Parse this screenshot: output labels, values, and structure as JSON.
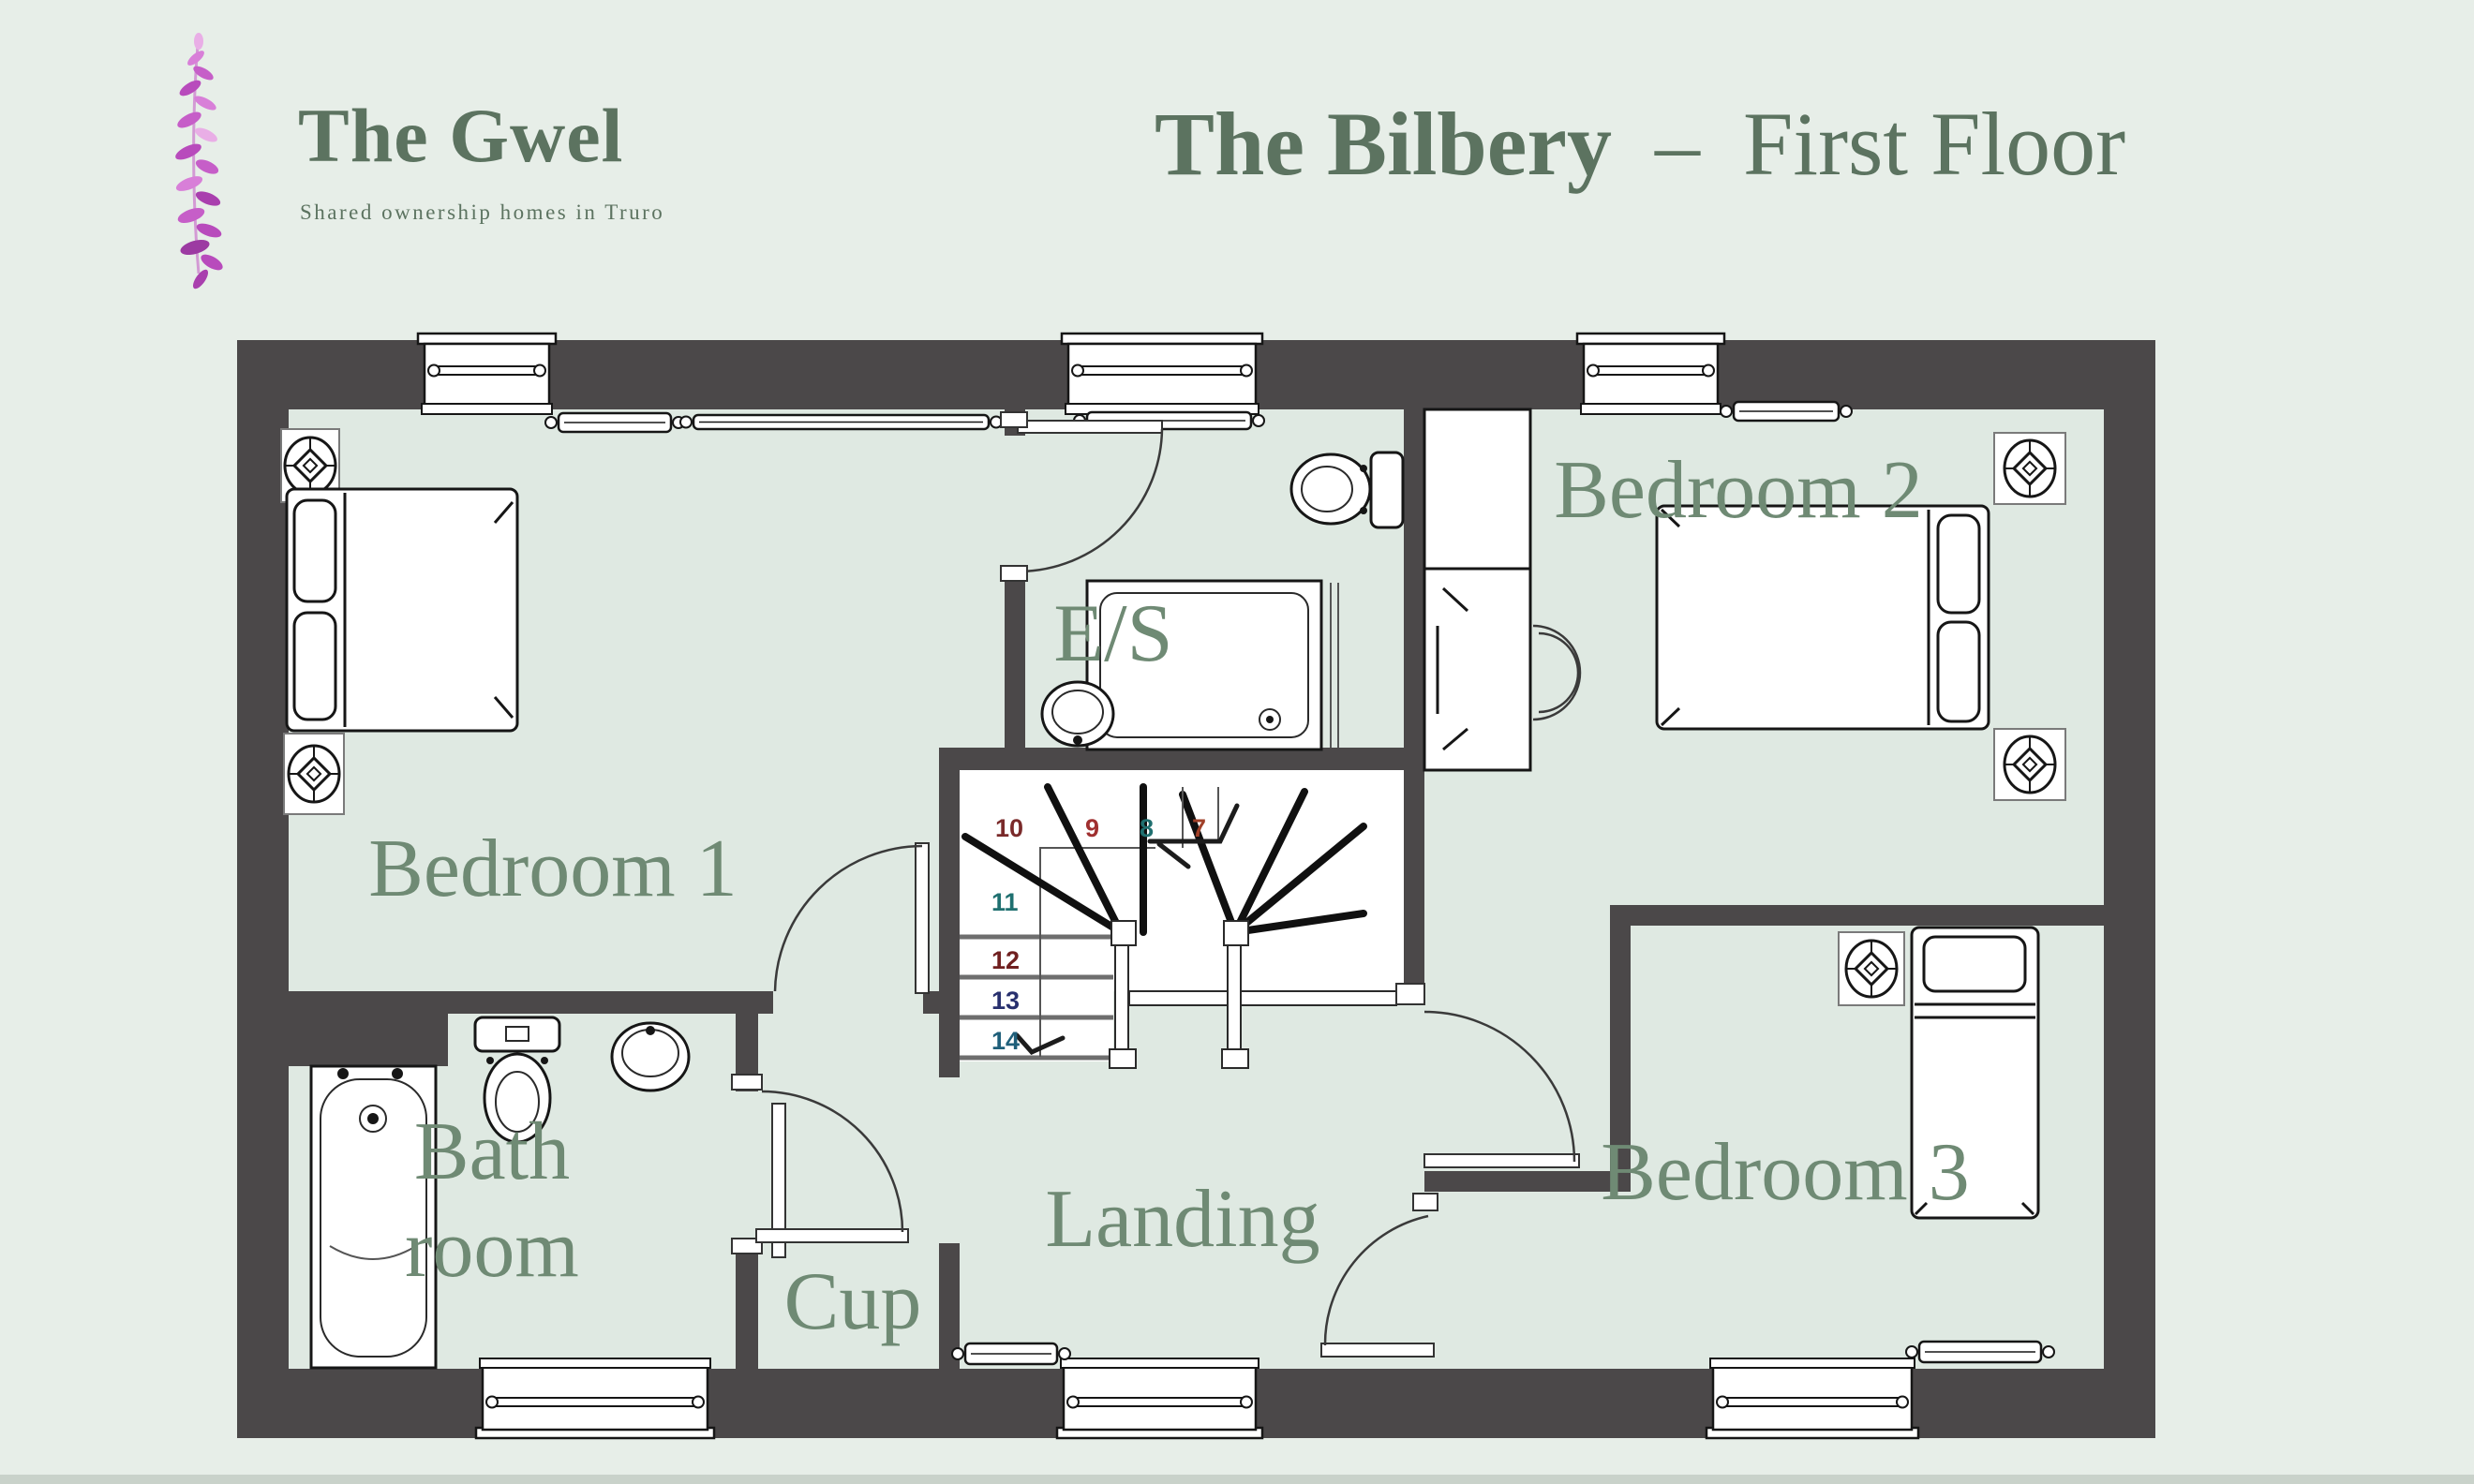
{
  "header": {
    "brand": "The Gwel",
    "tagline": "Shared ownership homes in Truro",
    "title_name": "The Bilbery",
    "title_sep": "–",
    "title_floor": "First Floor"
  },
  "plan": {
    "rooms": [
      {
        "id": "bedroom-1",
        "label": "Bedroom 1"
      },
      {
        "id": "bedroom-2",
        "label": "Bedroom 2"
      },
      {
        "id": "bedroom-3",
        "label": "Bedroom 3"
      },
      {
        "id": "ensuite",
        "label": "E/S"
      },
      {
        "id": "bathroom",
        "line1": "Bath",
        "line2": "room"
      },
      {
        "id": "cupboard",
        "label": "Cup"
      },
      {
        "id": "landing",
        "label": "Landing"
      }
    ],
    "fixtures": [
      "double-bed",
      "double-bed",
      "single-bed",
      "bath",
      "shower",
      "toilet",
      "toilet",
      "basin",
      "basin",
      "wardrobe",
      "desk",
      "chair",
      "bedside-table-lamp",
      "radiator",
      "window",
      "stairs"
    ]
  },
  "stairs": {
    "steps": [
      {
        "n": "7",
        "color": "#a04028"
      },
      {
        "n": "8",
        "color": "#1f6f6f"
      },
      {
        "n": "9",
        "color": "#a03030"
      },
      {
        "n": "10",
        "color": "#7a2a2a"
      },
      {
        "n": "11",
        "color": "#1f7070"
      },
      {
        "n": "12",
        "color": "#702020"
      },
      {
        "n": "13",
        "color": "#28306e"
      },
      {
        "n": "14",
        "color": "#1f5f7a"
      }
    ]
  },
  "colors": {
    "title_green": "#5c7360",
    "label_green": "#6f8a74",
    "wall": "#4b4849",
    "floor": "#dfe9e2",
    "page_bg": "#e7eee8",
    "sprig_pink": "#c65ec8"
  }
}
